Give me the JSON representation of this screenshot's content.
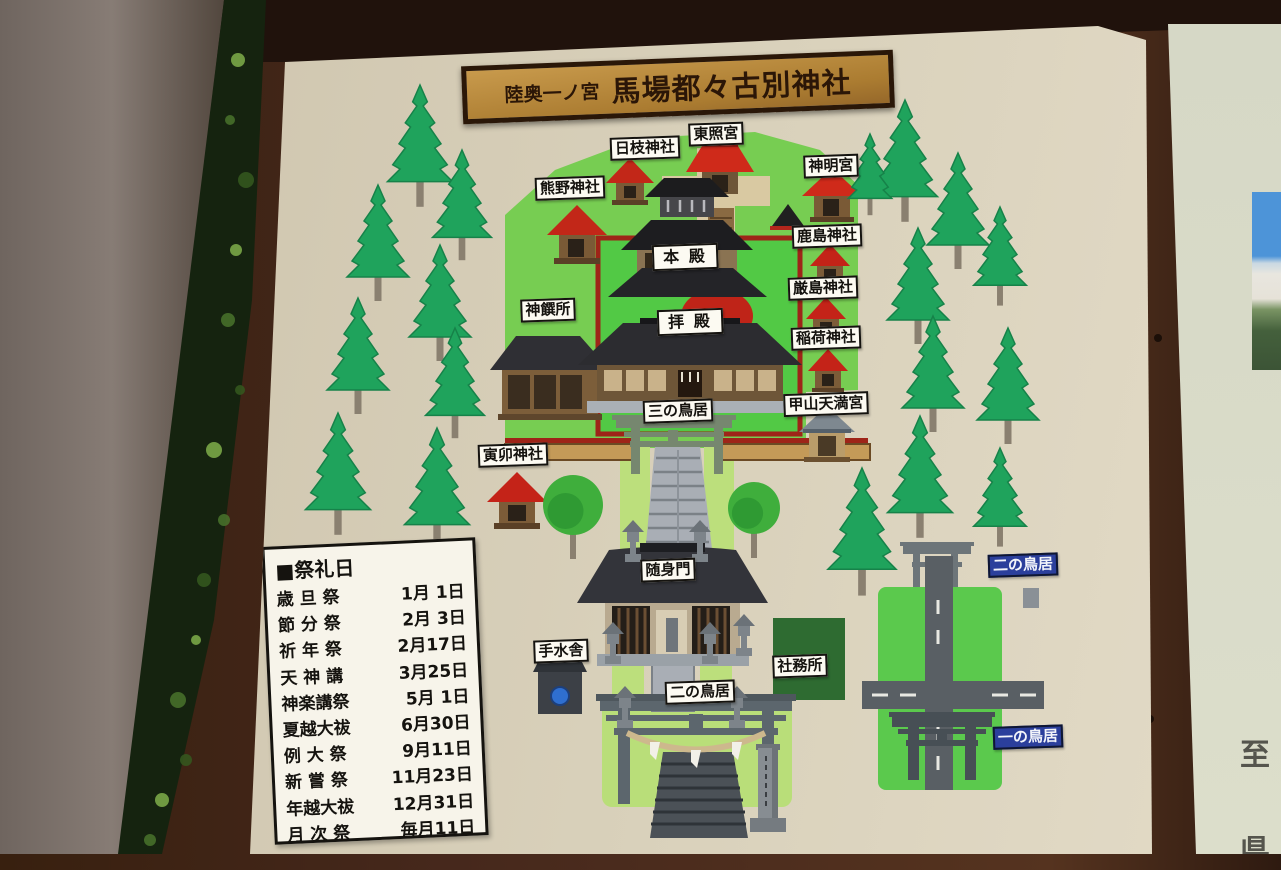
{
  "sign": {
    "title": {
      "prefix": "陸奥一ノ宮",
      "name": "馬場都々古別神社"
    },
    "festival": {
      "heading": "■祭礼日",
      "rows": [
        {
          "name": "歳 旦 祭",
          "date": "1月 1日"
        },
        {
          "name": "節 分 祭",
          "date": "2月 3日"
        },
        {
          "name": "祈 年 祭",
          "date": "2月17日"
        },
        {
          "name": "天 神 講",
          "date": "3月25日"
        },
        {
          "name": "神楽講祭",
          "date": "5月 1日"
        },
        {
          "name": "夏越大祓",
          "date": "6月30日"
        },
        {
          "name": "例 大 祭",
          "date": "9月11日"
        },
        {
          "name": "新 嘗 祭",
          "date": "11月23日"
        },
        {
          "name": "年越大祓",
          "date": "12月31日"
        },
        {
          "name": "月 次 祭",
          "date": "毎月11日"
        }
      ]
    },
    "labels": [
      {
        "id": "hie-jinja",
        "text": "日枝神社",
        "x": 645,
        "y": 148,
        "style": "white"
      },
      {
        "id": "toshogu",
        "text": "東照宮",
        "x": 716,
        "y": 134,
        "style": "white"
      },
      {
        "id": "kumano-jinja",
        "text": "熊野神社",
        "x": 570,
        "y": 188,
        "style": "white"
      },
      {
        "id": "shinmei-gu",
        "text": "神明宮",
        "x": 831,
        "y": 166,
        "style": "white"
      },
      {
        "id": "kashima-jinja",
        "text": "鹿島神社",
        "x": 827,
        "y": 236,
        "style": "white"
      },
      {
        "id": "itsukushima-jinja",
        "text": "厳島神社",
        "x": 823,
        "y": 288,
        "style": "white"
      },
      {
        "id": "inari-jinja",
        "text": "稲荷神社",
        "x": 826,
        "y": 338,
        "style": "white"
      },
      {
        "id": "shinsensho",
        "text": "神饌所",
        "x": 548,
        "y": 310,
        "style": "white"
      },
      {
        "id": "honden",
        "text": "本 殿",
        "x": 685,
        "y": 257,
        "style": "white wide"
      },
      {
        "id": "haiden",
        "text": "拝 殿",
        "x": 690,
        "y": 322,
        "style": "white wide"
      },
      {
        "id": "kabusan-tenmangu",
        "text": "甲山天満宮",
        "x": 826,
        "y": 404,
        "style": "white"
      },
      {
        "id": "sanno-torii",
        "text": "三の鳥居",
        "x": 678,
        "y": 411,
        "style": "white"
      },
      {
        "id": "torau-jinja",
        "text": "寅卯神社",
        "x": 513,
        "y": 455,
        "style": "white"
      },
      {
        "id": "zuishinmon",
        "text": "随身門",
        "x": 668,
        "y": 570,
        "style": "white"
      },
      {
        "id": "chozuya",
        "text": "手水舎",
        "x": 561,
        "y": 651,
        "style": "white"
      },
      {
        "id": "nino-torii",
        "text": "二の鳥居",
        "x": 700,
        "y": 692,
        "style": "white"
      },
      {
        "id": "shamusho",
        "text": "社務所",
        "x": 800,
        "y": 666,
        "style": "white"
      },
      {
        "id": "nino-torii-road",
        "text": "二の鳥居",
        "x": 1023,
        "y": 565,
        "style": "blue"
      },
      {
        "id": "ichino-torii",
        "text": "一の鳥居",
        "x": 1028,
        "y": 737,
        "style": "blue"
      }
    ],
    "trees": {
      "conifers": [
        [
          420,
          85,
          1.05
        ],
        [
          462,
          150,
          0.95
        ],
        [
          378,
          185,
          1.0
        ],
        [
          440,
          245,
          1.0
        ],
        [
          358,
          298,
          1.0
        ],
        [
          455,
          328,
          0.95
        ],
        [
          338,
          413,
          1.05
        ],
        [
          437,
          428,
          1.05
        ],
        [
          905,
          100,
          1.05
        ],
        [
          958,
          153,
          1.0
        ],
        [
          918,
          228,
          1.0
        ],
        [
          1000,
          207,
          0.85
        ],
        [
          933,
          316,
          1.0
        ],
        [
          1008,
          328,
          1.0
        ],
        [
          920,
          416,
          1.05
        ],
        [
          1000,
          448,
          0.85
        ],
        [
          862,
          468,
          1.1
        ],
        [
          870,
          134,
          0.7
        ]
      ],
      "round": [
        [
          573,
          505,
          30
        ],
        [
          754,
          508,
          26
        ]
      ]
    }
  },
  "side_panel": {
    "top_char": "至",
    "bottom_char": "県"
  },
  "colors": {
    "frame_brown": "#46281c",
    "sign_bg": "#d8cfb8",
    "map_green": "#77cd52",
    "courtyard_green": "#52c945",
    "path_green": "#bcdf7c",
    "wall_red": "#9e2418",
    "roof_red": "#c42318",
    "roof_dark": "#2c2c30",
    "road_gray": "#595f64",
    "tree_green": "#1fa35c",
    "label_blue": "#2b3f9c",
    "plaque_gold": "#b98a3e"
  }
}
